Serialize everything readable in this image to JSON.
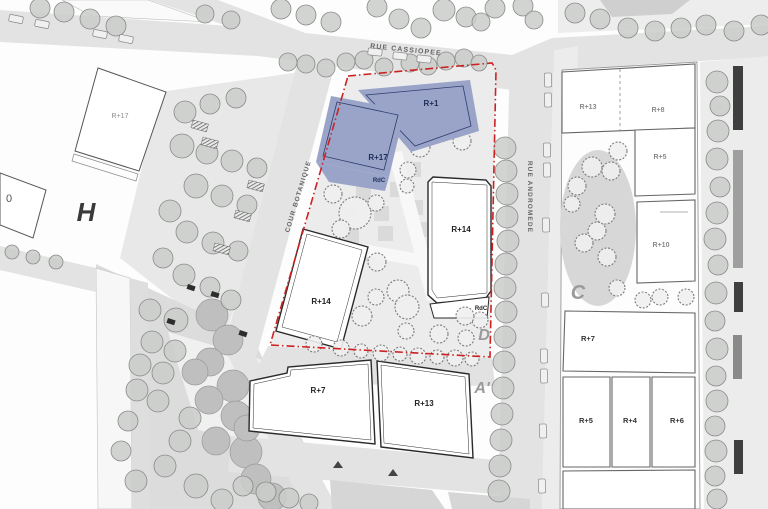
{
  "plan": {
    "streets": {
      "cassiopee": "RUE CASSIOPEE",
      "andromede": "RUE ANDROMEDE",
      "botanique": "COUR BOTANIQUE"
    },
    "zones": {
      "h": "H",
      "c": "C",
      "d": "D",
      "a_prime": "A'"
    },
    "buildings": {
      "blue_r1": "R+1",
      "blue_r17": "R+17",
      "blue_rdc": "RdC",
      "r14_east": "R+14",
      "r14_east_rdc": "RdC",
      "r14_west": "R+14",
      "r7_south": "R+7",
      "r13_south": "R+13",
      "r17_west": "R+17",
      "r0_west": "0",
      "c_r13": "R+13",
      "c_r8": "R+8",
      "c_r5_top": "R+5",
      "c_r10": "R+10",
      "c_r7": "R+7",
      "c_r5_bottom": "R+5",
      "c_r4": "R+4",
      "c_r6": "R+6"
    },
    "colors": {
      "project_fill": "#9aa4c9",
      "project_outline": "#2e3c6e",
      "boundary": "#cc2222"
    }
  }
}
